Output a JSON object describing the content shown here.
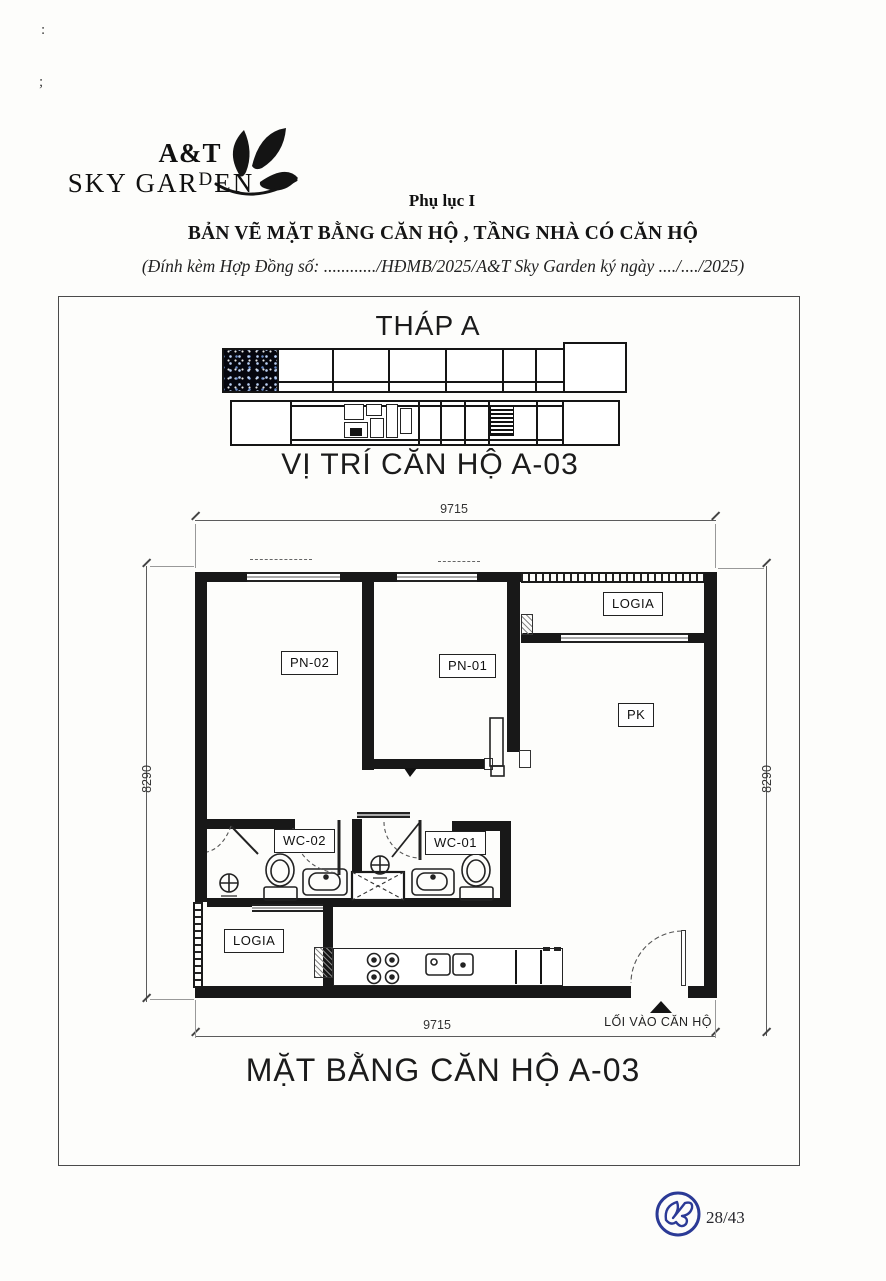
{
  "artifacts": {
    "mark_top": ":",
    "mark_mid": ";"
  },
  "header": {
    "logo": {
      "line1": "A&T",
      "line2_pre": "SKY GAR",
      "line2_d": "D",
      "line2_post": "EN"
    },
    "appendix_label": "Phụ lục I",
    "doc_title": "BẢN VẼ MẶT BẰNG CĂN HỘ , TẦNG NHÀ CÓ CĂN HỘ",
    "doc_subtitle": "(Đính kèm Hợp Đồng số: ............/HĐMB/2025/A&T Sky Garden ký ngày ..../..../2025)"
  },
  "drawing": {
    "tower_title": "THÁP A",
    "location_title": "VỊ TRÍ CĂN HỘ A-03",
    "plan_title": "MẶT BẰNG CĂN HỘ A-03",
    "entrance_label": "LỐI VÀO CĂN HỘ",
    "dimensions": {
      "top": "9715",
      "bottom": "9715",
      "left": "8290",
      "right": "8290"
    },
    "room_labels": {
      "logia_top": "LOGIA",
      "pn02": "PN-02",
      "pn01": "PN-01",
      "pk": "PK",
      "wc02": "WC-02",
      "wc01": "WC-01",
      "logia_bottom": "LOGIA"
    }
  },
  "footer": {
    "page_number": "28/43"
  },
  "colors": {
    "ink": "#1b1b1b",
    "stamp_navy": "#2b3a96"
  }
}
